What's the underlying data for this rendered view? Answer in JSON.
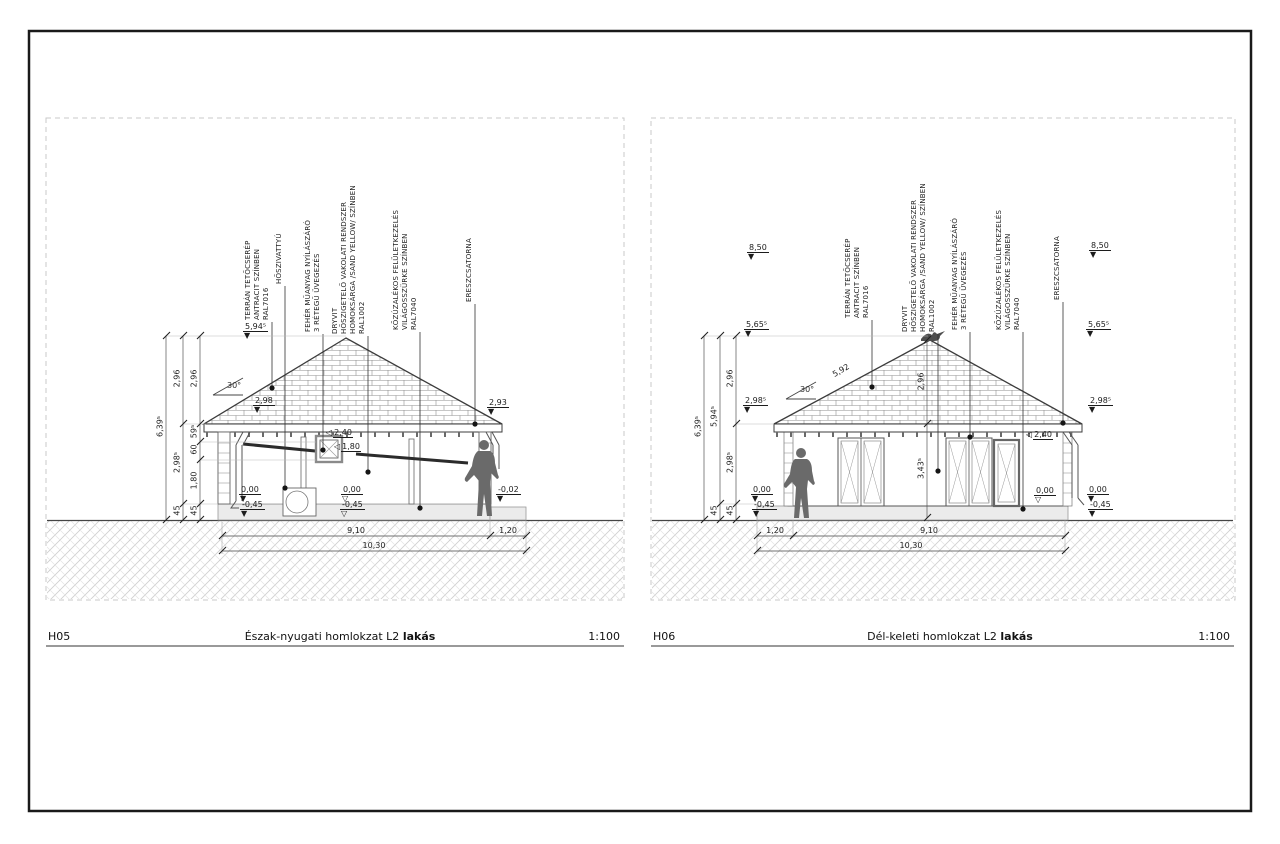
{
  "h05": {
    "code": "H05",
    "title": "Észak-nyugati homlokzat L2",
    "title_suffix": "lakás",
    "scale": "1:100",
    "slope": "30°",
    "vdims": [
      "6,39⁵",
      "2,96",
      "2,98⁵",
      "45",
      "2,96",
      "59⁵",
      "60",
      "1,80",
      "45"
    ],
    "levels": [
      "5,94⁵",
      "2,98",
      "2,93",
      "0,00",
      "-0,45",
      "0,00",
      "-0,45",
      "-0,02"
    ],
    "flags": [
      "2,40",
      "1,80"
    ],
    "bottom": [
      "9,10",
      "1,20",
      "10,30"
    ],
    "notes": {
      "tile": "TERRÁN TETŐCSERÉP\nANTRACIT SZÍNBEN\nRAL7016",
      "heatpump": "HŐSZIVATTYÚ",
      "window": "FEHÉR MŰANYAG NYÍLÁSZÁRÓ\n3 RÉTEGŰ ÜVEGEZÉS",
      "plaster": "DRYVIT\nHŐSZIGETELŐ VAKOLATI RENDSZER\nHOMOKSÁRGA /SAND YELLOW/ SZÍNBEN\nRAL1002",
      "plinth": "KŐZÚZALÉKOS FELÜLETKEZELÉS\nVILÁGOSSZÜRKE SZÍNBEN\nRAL7040",
      "gutter": "ERESZCSATORNA"
    }
  },
  "h06": {
    "code": "H06",
    "title": "Dél-keleti homlokzat L2",
    "title_suffix": "lakás",
    "scale": "1:100",
    "slope": "30°",
    "roof_dim": "5,92",
    "vdims": [
      "6,39⁵",
      "5,94⁵",
      "45",
      "2,96",
      "2,98⁵",
      "45",
      "2,96",
      "3,43⁵"
    ],
    "levels": [
      "8,50",
      "5,65⁵",
      "2,98⁵",
      "0,00",
      "-0,45",
      "8,50",
      "5,65⁵",
      "2,98⁵",
      "0,00",
      "-0,45",
      "0,00"
    ],
    "flag": "2,40",
    "bottom": [
      "1,20",
      "9,10",
      "10,30"
    ],
    "notes": {
      "tile": "TERRÁN TETŐCSERÉP\nANTRACIT SZÍNBEN\nRAL7016",
      "plaster": "DRYVIT\nHŐSZIGETELŐ VAKOLATI RENDSZER\nHOMOKSÁRGA /SAND YELLOW/ SZÍNBEN\nRAL1002",
      "window": "FEHÉR MŰANYAG NYÍLÁSZÁRÓ\n3 RÉTEGŰ ÜVEGEZÉS",
      "plinth": "KŐZÚZALÉKOS FELÜLETKEZELÉS\nVILÁGOSSZÜRKE SZÍNBEN\nRAL7040",
      "gutter": "ERESZCSATORNA"
    }
  }
}
